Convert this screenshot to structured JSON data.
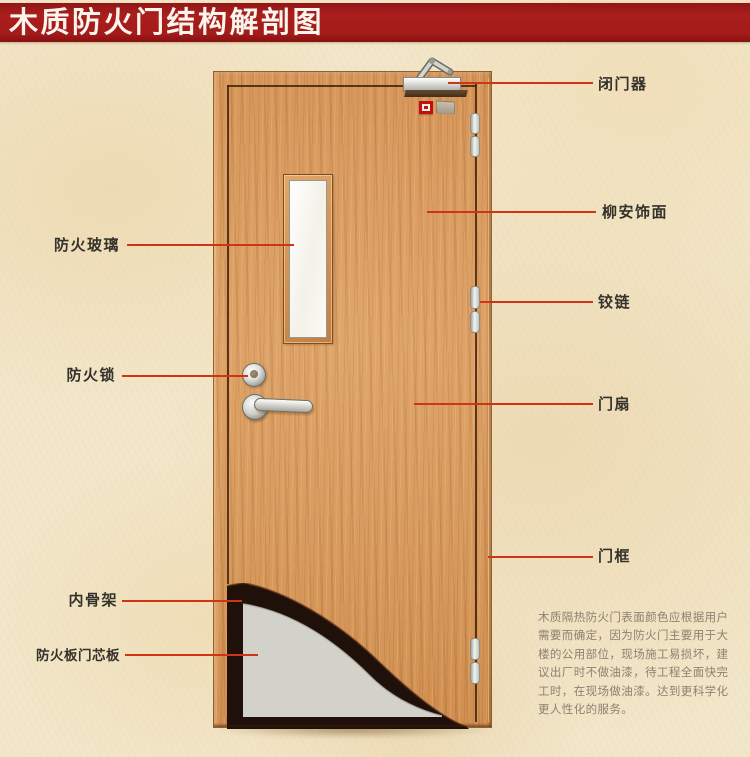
{
  "title": "木质防火门结构解剖图",
  "annotations": {
    "left": [
      "防火玻璃",
      "防火锁",
      "内骨架",
      "防火板门芯板"
    ],
    "right": [
      "闭门器",
      "柳安饰面",
      "铰链",
      "门扇",
      "门框"
    ]
  },
  "description": {
    "lines": [
      "木质隔热防火门表面颜色应根据用户",
      "需要而确定，因为防火门主要用于大",
      "楼的公用部位，现场施工易损坏，建",
      "议出厂时不做油漆，待工程全面快完",
      "工时，在现场做油漆。达到更科学化",
      "更人性化的服务。"
    ]
  },
  "colors": {
    "banner_red": "#a81e1c",
    "annotation_line_red": "#cf3415",
    "wood": "#d6975c",
    "core_panel_gray": "#d3d2ca",
    "inner_frame_dark": "#20100a",
    "parchment_background": "#f2e6c9"
  }
}
